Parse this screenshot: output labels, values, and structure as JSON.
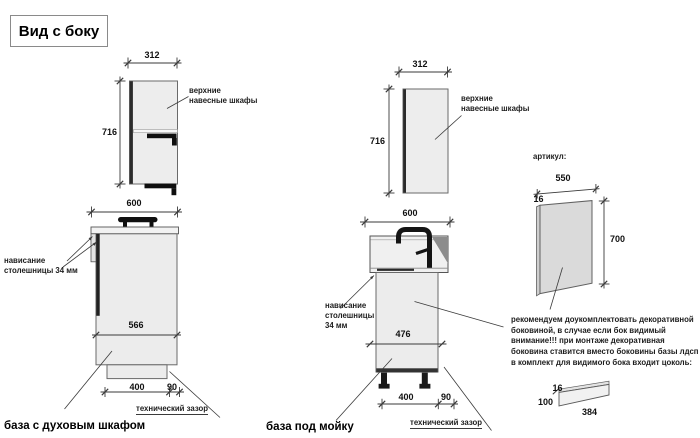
{
  "title": "Вид с боку",
  "colors": {
    "warning_red": "#c23b2e",
    "drawing_line": "#3a3a3a",
    "cabinet_fill": "#ededed",
    "panel_fill": "#dadada"
  },
  "wall_cabinets": {
    "label": "верхние навесные шкафы",
    "width": "312",
    "height": "716"
  },
  "oven_base": {
    "caption": "база с духовым шкафом",
    "top_width": "600",
    "inner_depth": "566",
    "plinth_offset": "400",
    "tech_gap_mm": "90",
    "overhang_label": "нависание столешницы 34 мм",
    "tech_gap_label": "технический зазор"
  },
  "sink_base": {
    "caption": "база под мойку",
    "top_width": "600",
    "inner_depth": "476",
    "plinth_offset": "400",
    "tech_gap_mm": "90",
    "overhang_label": "нависание столешницы 34 мм",
    "tech_gap_label": "технический зазор"
  },
  "decor_panel": {
    "article_label": "артикул:",
    "width": "550",
    "thickness": "16",
    "height": "700"
  },
  "note": {
    "line1": "рекомендуем доукомплектовать декоративной",
    "line2": "боковиной, в случае если бок видимый",
    "line3": "внимание!!! при монтаже декоративная",
    "line4": "боковина ставится вместо боковины базы лдсп",
    "line5": "в комплект для видимого бока входит цоколь:"
  },
  "plinth_item": {
    "thickness": "16",
    "height": "100",
    "length": "384"
  }
}
